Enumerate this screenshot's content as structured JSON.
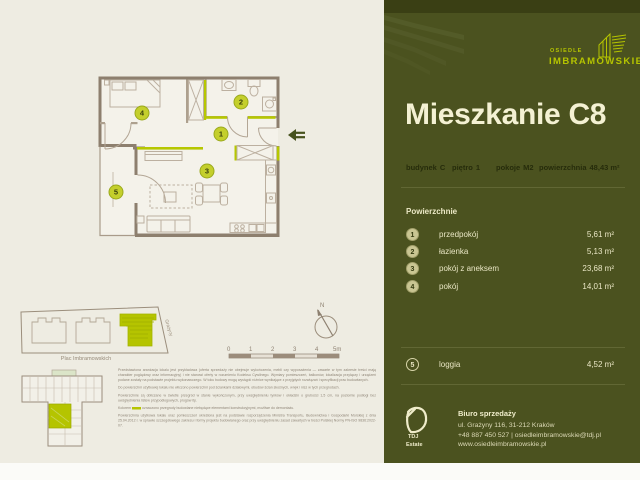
{
  "colors": {
    "accent": "#b5c400",
    "panel": "#4b521f",
    "cream": "#f2efd0",
    "wall": "#8d7f6e"
  },
  "brand": {
    "line1": "OSIEDLE",
    "line2": "IMBRAMOWSKIE",
    "estate_line1": "TDJ",
    "estate_line2": "Estate"
  },
  "header": {
    "title": "Mieszkanie C8"
  },
  "info": [
    {
      "label": "budynek",
      "value": "C"
    },
    {
      "label": "piętro",
      "value": "1"
    },
    {
      "label": "pokoje",
      "value": "M2"
    },
    {
      "label": "powierzchnia",
      "value": "48,43 m²"
    }
  ],
  "areas": {
    "heading": "Powierzchnie",
    "rooms": [
      {
        "num": "1",
        "label": "przedpokój",
        "area": "5,61 m²"
      },
      {
        "num": "2",
        "label": "łazienka",
        "area": "5,13 m²"
      },
      {
        "num": "3",
        "label": "pokój z aneksem",
        "area": "23,68 m²"
      },
      {
        "num": "4",
        "label": "pokój",
        "area": "14,01 m²"
      }
    ],
    "loggia": {
      "num": "5",
      "label": "loggia",
      "area": "4,52 m²"
    }
  },
  "contact": {
    "heading": "Biuro sprzedaży",
    "address": "ul. Grażyny 116, 31-212 Kraków",
    "phone_email": "+48 887 450 527 | osiedleimbramowskie@tdj.pl",
    "website": "www.osiedleimbramowskie.pl"
  },
  "plan": {
    "numbers": [
      "1",
      "2",
      "3",
      "4",
      "5"
    ]
  },
  "site": {
    "label": "Plac Imbramowskich",
    "street": "Grażyny"
  },
  "scale": {
    "labels": [
      "0",
      "1",
      "2",
      "3",
      "4",
      "5m"
    ]
  },
  "compass": {
    "north": "N"
  },
  "disclaimer": {
    "p1": "Przedstawiona aranżacja lokalu jest przykładowa (oferta sprzedaży nie obejmuje wykończenia, mebli czy wyposażenia — zawarte w tym zakresie treści mają charakter poglądowy oraz informacyjny) i nie stanowi oferty w rozumieniu Kodeksu Cywilnego. Wymiary pomieszczeń, balkonów, lokalizacja przyłączy i urządzeń podane zostały na podstawie projektu wykonawczego. W toku budowy mogą wystąpić różnice wynikające z przyjętych rozwiązań i specyfikacji prac budowlanych.",
    "p2": "Do powierzchni użytkowej lokalu nie wliczono powierzchni pod ściankami działowymi, obudów ścian skośnych, wnęk i nisz w tych przegrodach.",
    "p3": "Powierzchnie są obliczane w świetle przegród w stanie wykończonym, przy uwzględnieniu tynków i okładzin o grubości 1,5 cm, na poziomie podłogi bez uwzględnienia listew przypodłogowych, progów itp.",
    "p4_before": "Kolorem",
    "p4_after": "oznaczono przegrody budowlane niebędące elementami konstrukcyjnymi, możliwe do demontażu.",
    "p5": "Powierzchnia użytkowa lokalu oraz pomieszczeń określona jest na podstawie rozporządzenia Ministra Transportu, Budownictwa i Gospodarki Morskiej z dnia 25.04.2012 r. w sprawie szczegółowego zakresu i formy projektu budowlanego oraz przy uwzględnieniu zasad zawartych w treści Polskiej Normy PN-ISO 9836:2022-07."
  }
}
